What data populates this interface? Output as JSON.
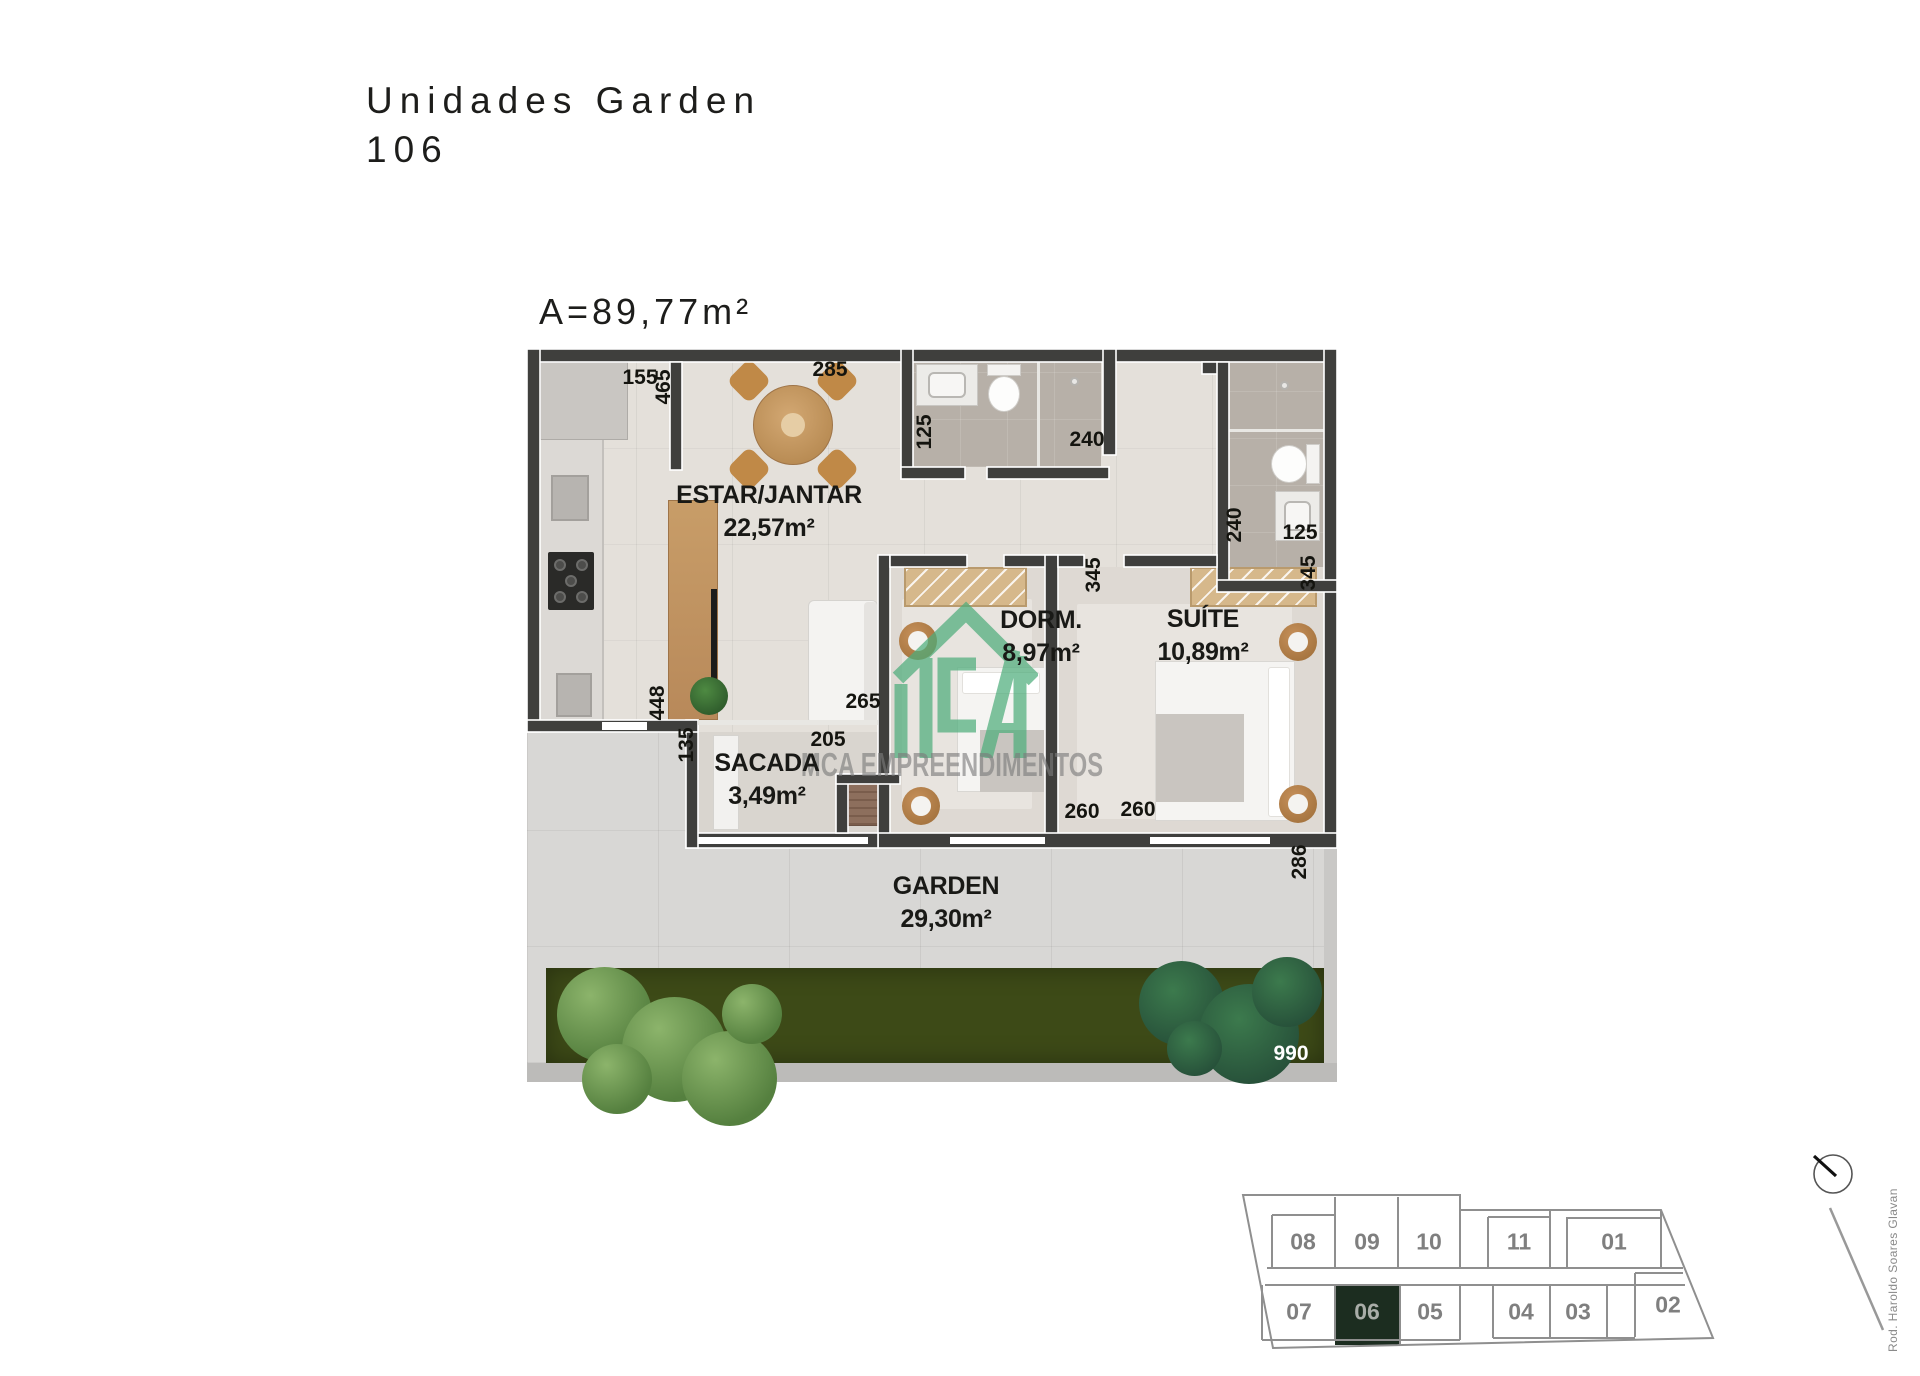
{
  "page": {
    "title_line1": "Unidades Garden",
    "title_line2": "106",
    "area_label": "A=89,77m²"
  },
  "rooms": [
    {
      "name": "ESTAR/JANTAR",
      "area": "22,57m²"
    },
    {
      "name": "DORM.",
      "area": "8,97m²"
    },
    {
      "name": "SUÍTE",
      "area": "10,89m²"
    },
    {
      "name": "SACADA",
      "area": "3,49m²"
    },
    {
      "name": "GARDEN",
      "area": "29,30m²"
    }
  ],
  "dimensions": [
    "155",
    "465",
    "285",
    "125",
    "240",
    "240",
    "125",
    "345",
    "345",
    "265",
    "448",
    "135",
    "205",
    "260",
    "260",
    "286",
    "990"
  ],
  "watermark": {
    "brand": "MCA EMPREENDIMENTOS"
  },
  "keyplan": {
    "street": "Rod. Haroldo Soares Glavan",
    "highlighted_unit": "06",
    "top_row": [
      "08",
      "09",
      "10",
      "11",
      "01"
    ],
    "bottom_row": [
      "07",
      "06",
      "05",
      "04",
      "03",
      "02"
    ]
  },
  "colors": {
    "wall": "#3f3f3d",
    "floor": "#e4e0da",
    "bathroom_floor": "#b7b0a8",
    "grass": "#3d4a17",
    "watermark_green": "#4fae7c",
    "keyplan_stroke": "#8f8f8f",
    "keyplan_highlight": "#1c2d20",
    "text_dark": "#1d1d1b"
  }
}
